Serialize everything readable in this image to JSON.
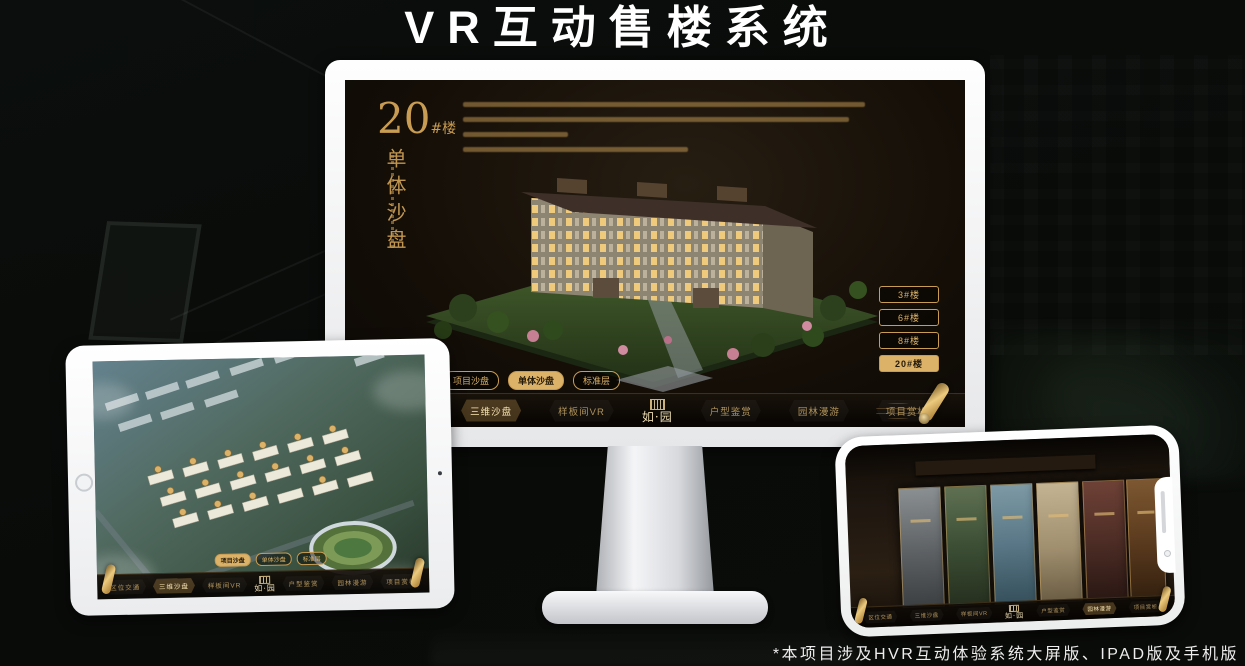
{
  "page": {
    "title": "VR互动售楼系统",
    "footnote": "*本项目涉及HVR互动体验系统大屏版、IPAD版及手机版"
  },
  "brand": {
    "logo_name": "如·园"
  },
  "nav": {
    "items": [
      {
        "label": "区位交通"
      },
      {
        "label": "三维沙盘"
      },
      {
        "label": "样板间VR"
      },
      {
        "label": "户型鉴赏"
      },
      {
        "label": "园林漫游"
      },
      {
        "label": "项目赏析"
      }
    ],
    "active_on_desktop": "三维沙盘",
    "active_on_tablet": "三维沙盘",
    "active_on_phone": "园林漫游"
  },
  "view_tabs": [
    {
      "label": "项目沙盘"
    },
    {
      "label": "单体沙盘"
    },
    {
      "label": "标准层"
    }
  ],
  "desktop": {
    "active_view_tab": "单体沙盘",
    "unit": {
      "number": "20",
      "suffix": "#楼",
      "subtitle": "单体沙盘"
    },
    "floor_buttons": [
      {
        "label": "3#楼",
        "active": false
      },
      {
        "label": "6#楼",
        "active": false
      },
      {
        "label": "8#楼",
        "active": false
      },
      {
        "label": "20#楼",
        "active": true
      }
    ]
  },
  "tablet": {
    "active_view_tab": "项目沙盘"
  },
  "colors": {
    "gold": "#c89c52",
    "gold_bright": "#ecca7e",
    "active_tab_bg": "#dcb269",
    "screen_bg": "#140e07",
    "title_text": "#ffffff"
  }
}
